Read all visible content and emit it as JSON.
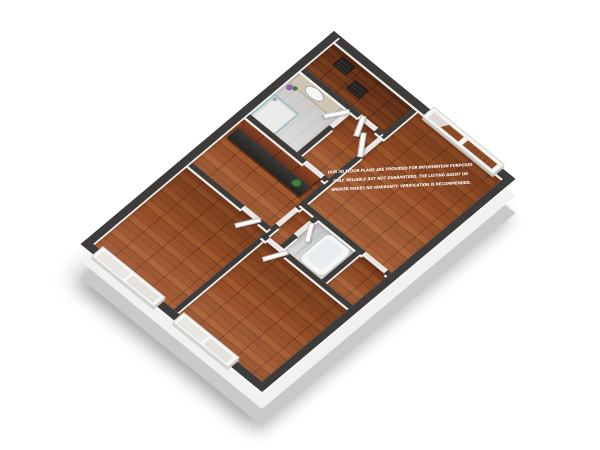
{
  "disclaimer": {
    "line1": "OUR 3D FLOOR PLANS ARE PROVIDED FOR INFORMATION PURPOSES",
    "line2": "ONLY. RELIABLE BUT NOT GUARANTEED. THE LISTING AGENT OR",
    "line3": "BROKER MAKES NO WARRANTY. VERIFICATION IS RECOMMENDED.",
    "text_color": "#ffffff"
  },
  "palette": {
    "background": "#ffffff",
    "wood_floor": "#9c512a",
    "wall_cap": "#3e3c3a",
    "wall_face": "#f1f1ef",
    "base_plinth": "#c9c9c7",
    "kitchen_cabinet": "#7c3a22",
    "countertop": "#2d2d2c",
    "tile_floor": "#dadad8",
    "glass": "#bcd3da",
    "plant_green": "#3f7d3a",
    "flower_purple": "#9b59b6"
  },
  "elements": {
    "rooms": [
      "landing-hall",
      "bathroom-1",
      "inner-hall",
      "kitchen",
      "bedroom-1",
      "master-bedroom",
      "mini-hall",
      "bathroom-2",
      "closet-nook",
      "bedroom-2"
    ],
    "fixtures": [
      "kitchen-upper-cabinets",
      "kitchen-countertop",
      "kitchen-plant",
      "vanity",
      "vanity-sink",
      "vanity-mirror",
      "flower-pot",
      "shower-enclosure",
      "bathtub",
      "glass-partition",
      "stair-mats"
    ],
    "windows": [
      "master-bedroom-window",
      "bedroom-1-window",
      "bedroom-2-window"
    ],
    "doors": [
      "master-door",
      "hall-door",
      "bathroom-1-door",
      "bathroom-2-door",
      "bedroom-1-door",
      "bedroom-2-door"
    ]
  }
}
